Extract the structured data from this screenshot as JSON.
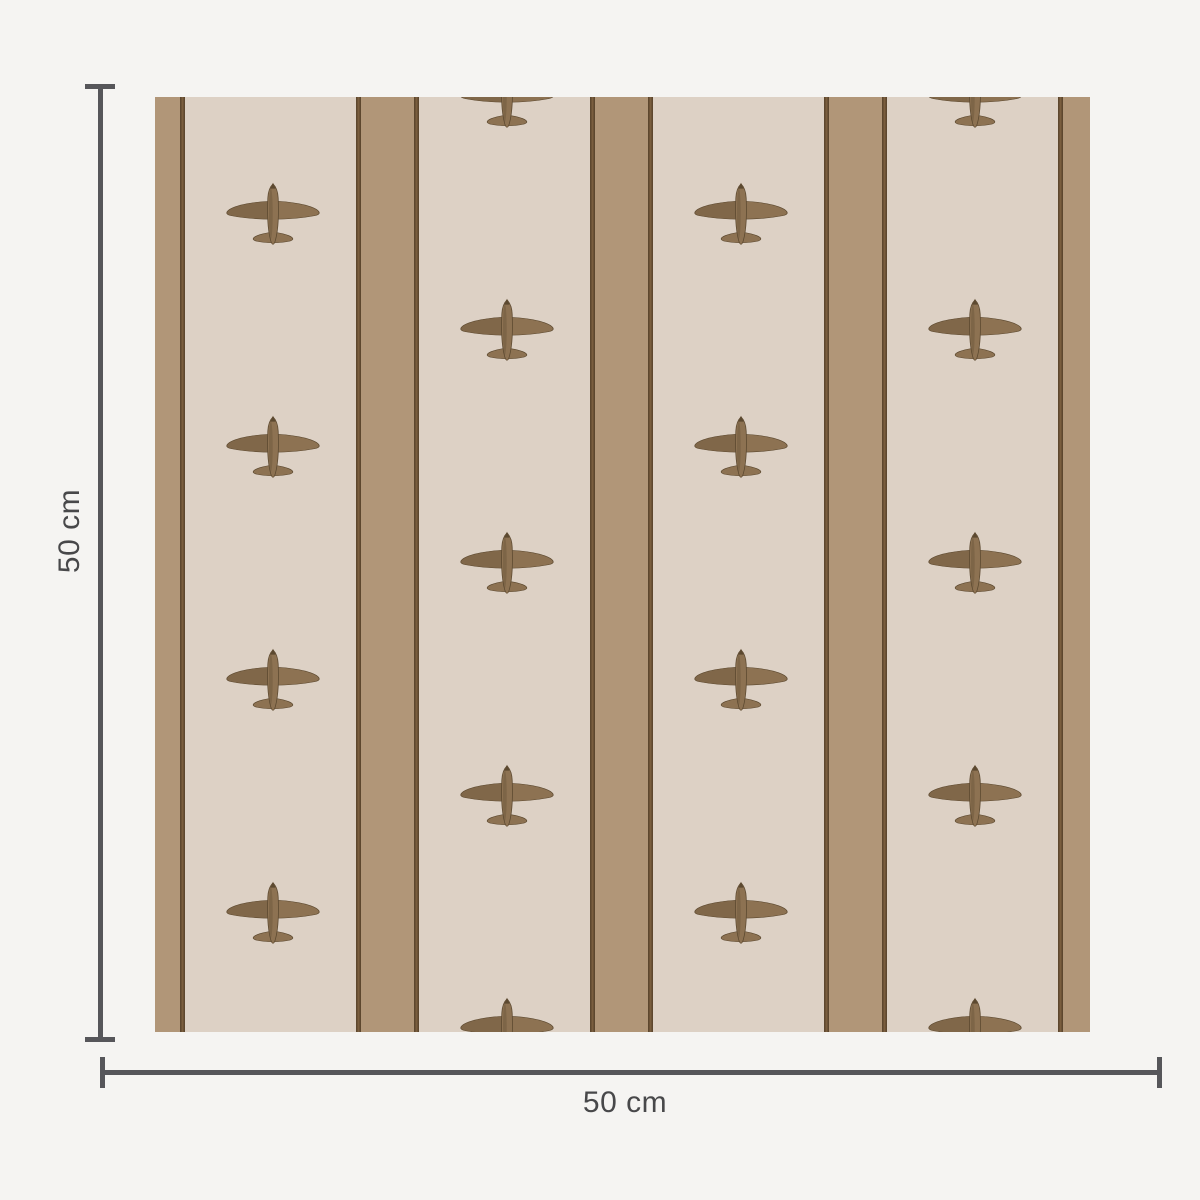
{
  "page": {
    "background_color": "#f5f4f2"
  },
  "dimension_annotations": {
    "height": {
      "label": "50 cm"
    },
    "width": {
      "label": "50 cm"
    },
    "line_color": "#56565a",
    "label_color": "#48484a"
  },
  "wallpaper_swatch": {
    "description": "beige and tan striped wallpaper sample with brown vintage airplane motifs",
    "colors": {
      "field_beige": "#ddd1c5",
      "stripe_tan": "#b19678",
      "stripe_dark_edge": "#5d472e",
      "stripe_dark_mid": "#7a5e3e",
      "plane_body": "#8d7252",
      "plane_shade": "#6d573c",
      "plane_outline": "#5c4930"
    },
    "airplane_positions": [
      {
        "x": 118,
        "y": 117
      },
      {
        "x": 118,
        "y": 350
      },
      {
        "x": 118,
        "y": 583
      },
      {
        "x": 118,
        "y": 816
      },
      {
        "x": 352,
        "y": 0
      },
      {
        "x": 352,
        "y": 233
      },
      {
        "x": 352,
        "y": 466
      },
      {
        "x": 352,
        "y": 699
      },
      {
        "x": 352,
        "y": 932
      },
      {
        "x": 586,
        "y": 117
      },
      {
        "x": 586,
        "y": 350
      },
      {
        "x": 586,
        "y": 583
      },
      {
        "x": 586,
        "y": 816
      },
      {
        "x": 820,
        "y": 0
      },
      {
        "x": 820,
        "y": 233
      },
      {
        "x": 820,
        "y": 466
      },
      {
        "x": 820,
        "y": 699
      },
      {
        "x": 820,
        "y": 932
      }
    ]
  }
}
